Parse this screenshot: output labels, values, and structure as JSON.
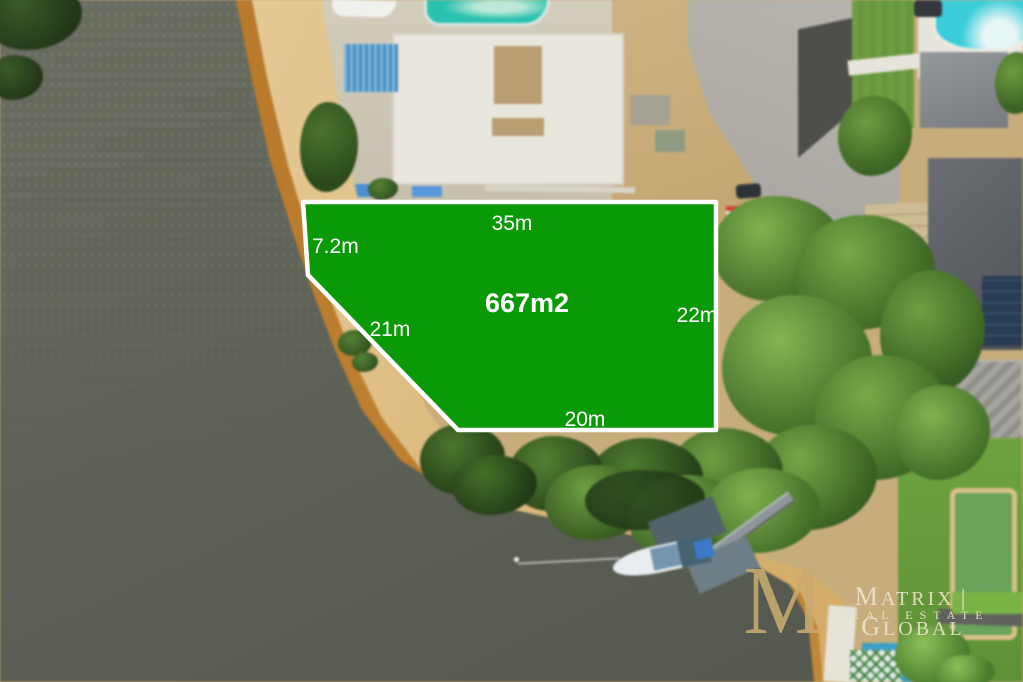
{
  "overlay": {
    "fill_color": "#0a9a07",
    "border_color": "#ffffff",
    "area_label": "667m2",
    "measurements": {
      "top": "35m",
      "left_upper": "7.2m",
      "left_diagonal": "21m",
      "right": "22m",
      "bottom": "20m"
    }
  },
  "watermark": {
    "monogram": "M",
    "brand_primary": "MATRIX",
    "separator": "|",
    "brand_secondary": "GLOBAL",
    "tagline": "REAL ESTATE",
    "gold_color": "#c8a96e",
    "text_color": "#ece2c8"
  }
}
